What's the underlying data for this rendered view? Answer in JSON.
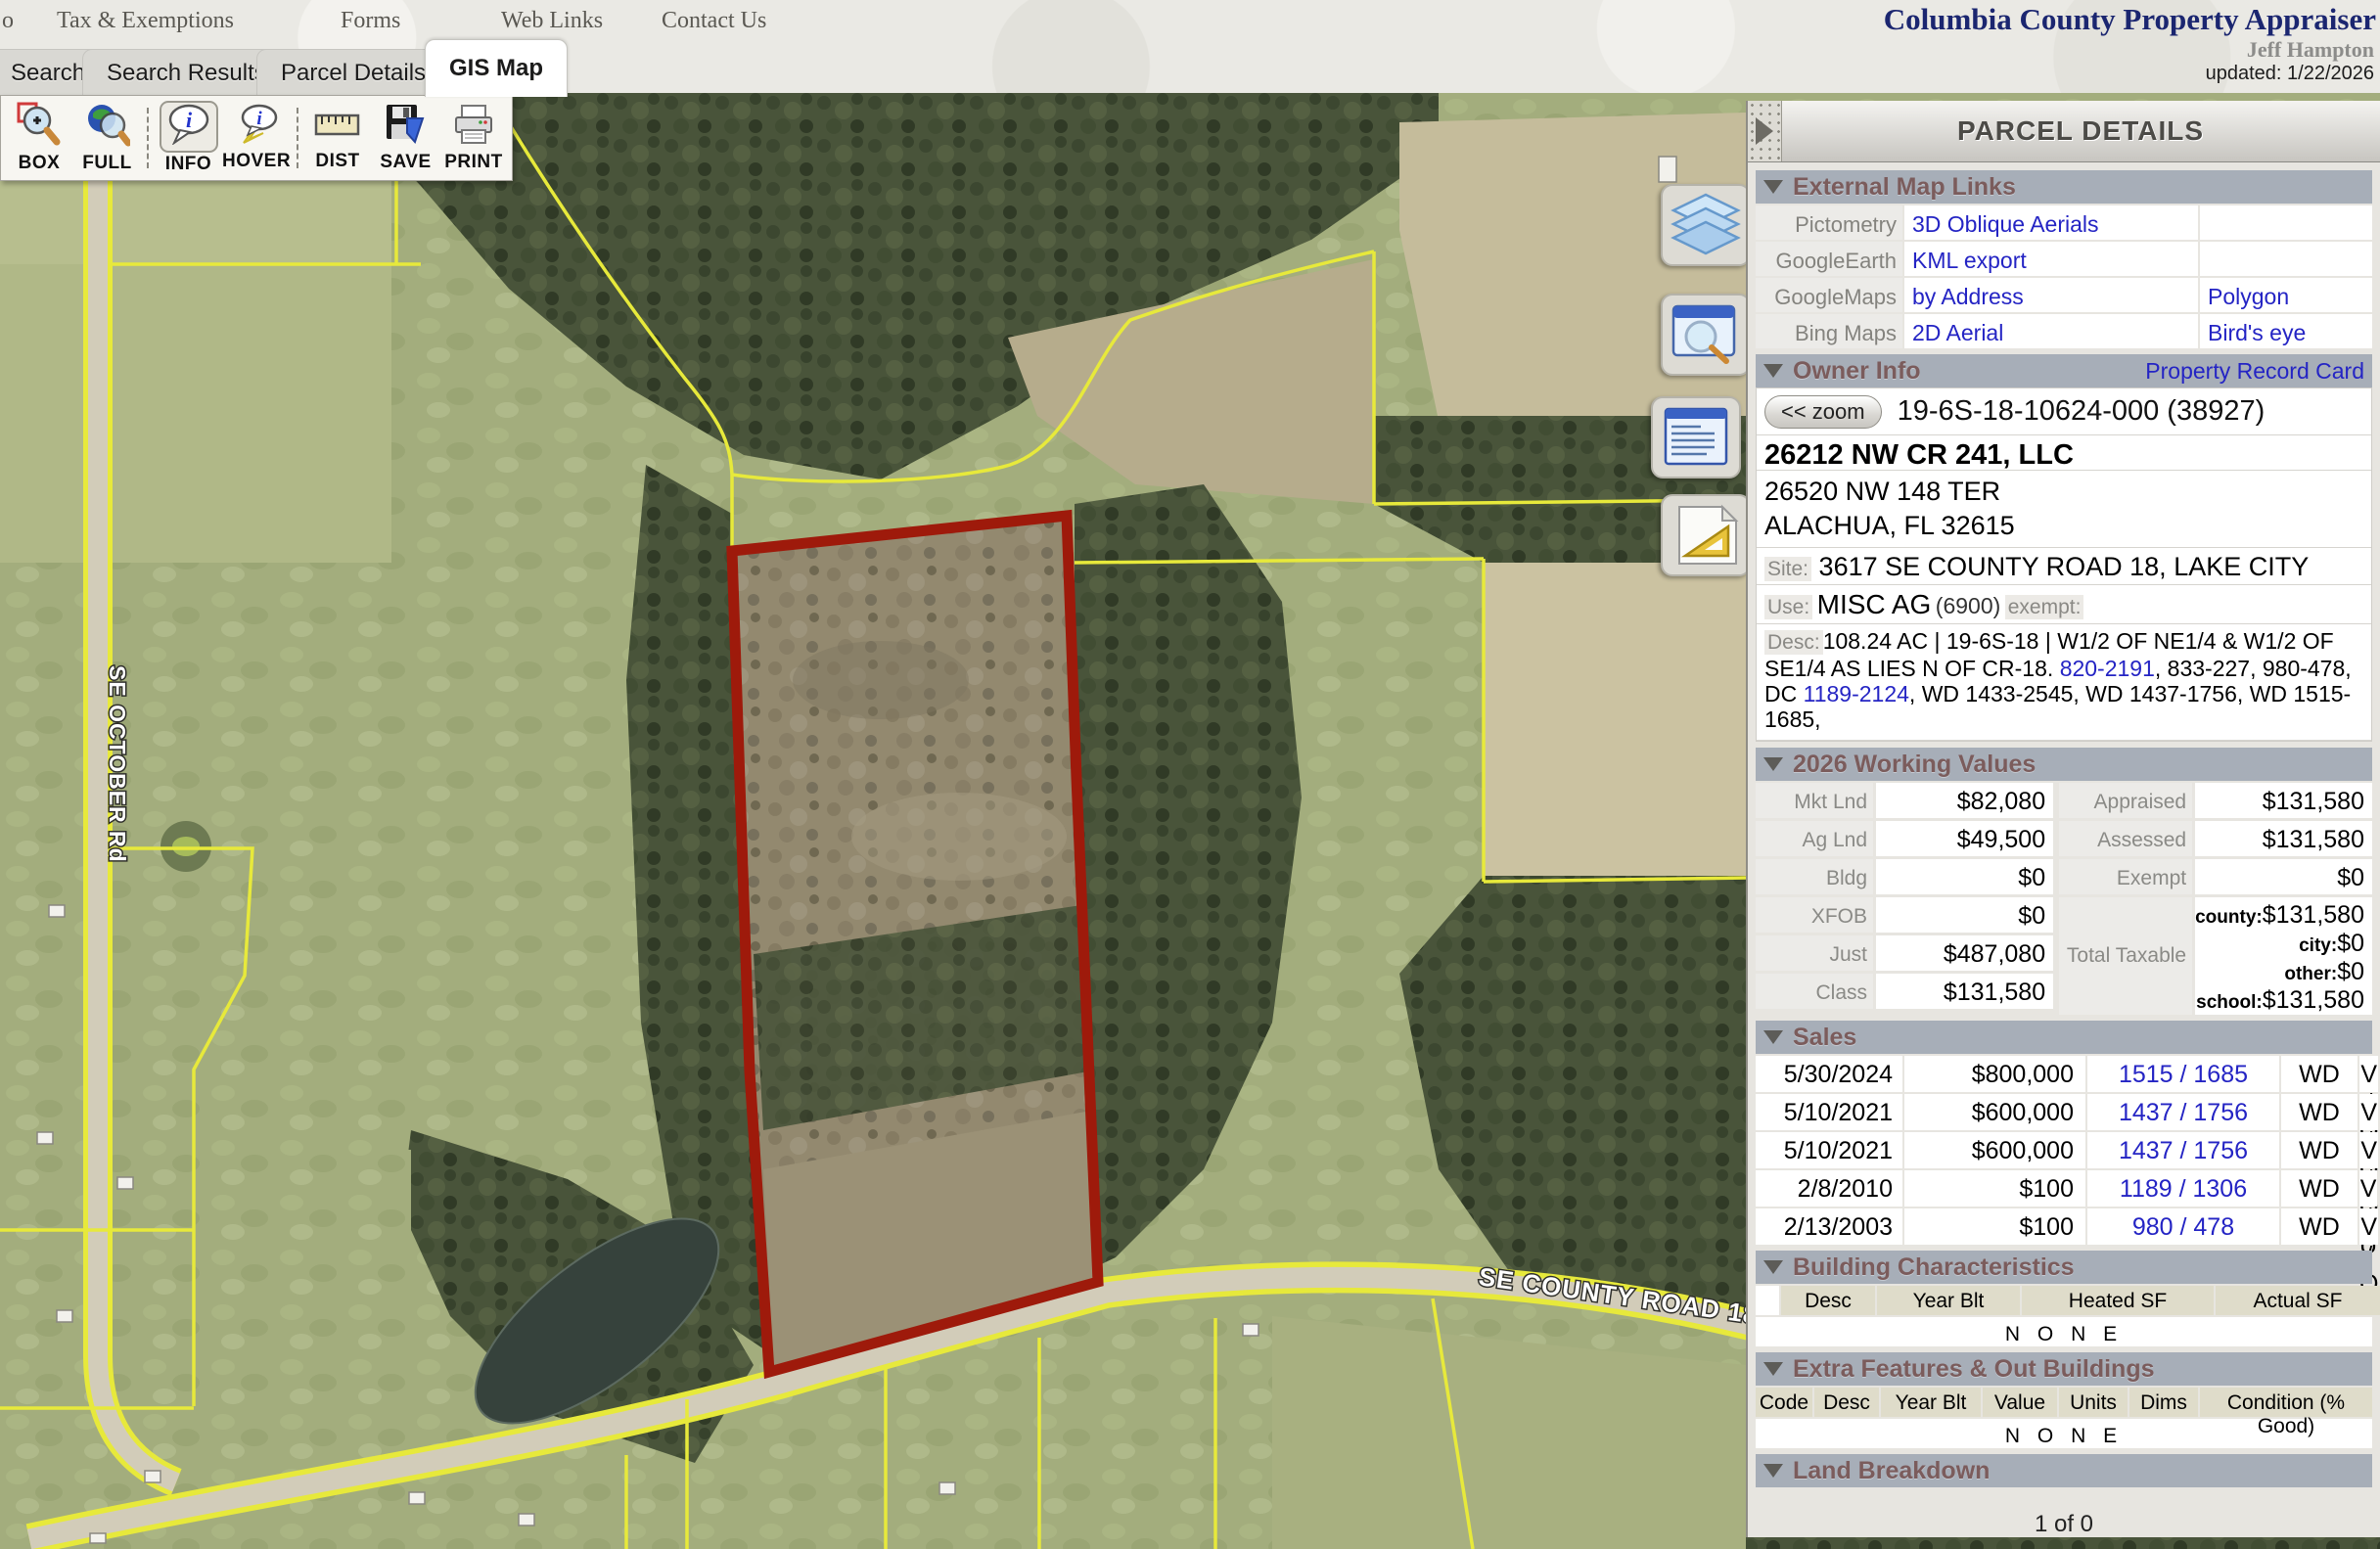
{
  "header": {
    "nav_partial": "o",
    "nav_items": [
      "Tax & Exemptions",
      "Forms",
      "Web Links",
      "Contact Us"
    ],
    "title": "Columbia County Property Appraiser",
    "appraiser": "Jeff Hampton",
    "updated": "updated: 1/22/2026"
  },
  "tabs": [
    {
      "label": "Search"
    },
    {
      "label": "Search Results"
    },
    {
      "label": "Parcel Details"
    },
    {
      "label": "GIS Map"
    }
  ],
  "toolbar": {
    "buttons": [
      {
        "label": "BOX",
        "icon": "zoom-box-icon"
      },
      {
        "label": "FULL",
        "icon": "zoom-full-icon"
      },
      {
        "label": "INFO",
        "icon": "info-bubble-icon",
        "active": true
      },
      {
        "label": "HOVER",
        "icon": "hover-bubble-icon"
      },
      {
        "label": "DIST",
        "icon": "distance-ruler-icon"
      },
      {
        "label": "SAVE",
        "icon": "save-disk-icon"
      },
      {
        "label": "PRINT",
        "icon": "printer-icon"
      }
    ]
  },
  "side_tools": [
    {
      "icon": "layers-icon"
    },
    {
      "icon": "identify-window-icon"
    },
    {
      "icon": "report-window-icon"
    },
    {
      "icon": "measure-icon"
    }
  ],
  "map": {
    "labels": {
      "vertical_road": "SE OCTOBER Rd",
      "bottom_road": "SE COUNTY ROAD 18"
    },
    "colors": {
      "parcel_outline": "#9e1a0b",
      "boundary_lines": "#e7e93b"
    }
  },
  "panel": {
    "title": "PARCEL DETAILS",
    "external_links": {
      "title": "External Map Links",
      "rows": [
        {
          "label": "Pictometry",
          "link1": "3D Oblique Aerials",
          "link2": ""
        },
        {
          "label": "GoogleEarth",
          "link1": "KML export",
          "link2": ""
        },
        {
          "label": "GoogleMaps",
          "link1": "by Address",
          "link2": "Polygon"
        },
        {
          "label": "Bing Maps",
          "link1": "2D Aerial",
          "link2": "Bird's eye"
        }
      ]
    },
    "owner_info": {
      "title": "Owner Info",
      "record_card": "Property Record Card",
      "zoom_button": "<< zoom",
      "parcel_id": "19-6S-18-10624-000 (38927)",
      "owner_name": "26212 NW CR 241, LLC",
      "address_line1": "26520 NW 148 TER",
      "address_line2": "ALACHUA, FL 32615",
      "site_label": "Site:",
      "site_value": "3617 SE COUNTY ROAD 18, LAKE CITY",
      "use_label": "Use:",
      "use_value": "MISC AG",
      "use_code": "(6900)",
      "exempt_label": "exempt:",
      "desc_label": "Desc:",
      "desc_part1": "108.24 AC |  19-6S-18 | W1/2 OF NE1/4 & W1/2 OF SE1/4 AS LIES N OF CR-18.  ",
      "desc_link1": "820-2191",
      "desc_part2": ", 833-227, 980-478, DC ",
      "desc_link2": "1189-2124",
      "desc_part3": ", WD 1433-2545, WD 1437-1756, WD 1515-1685,"
    },
    "working_values": {
      "title": "2026 Working Values",
      "left": [
        {
          "label": "Mkt Lnd",
          "value": "$82,080"
        },
        {
          "label": "Ag Lnd",
          "value": "$49,500"
        },
        {
          "label": "Bldg",
          "value": "$0"
        },
        {
          "label": "XFOB",
          "value": "$0"
        },
        {
          "label": "Just",
          "value": "$487,080"
        },
        {
          "label": "Class",
          "value": "$131,580"
        }
      ],
      "right": [
        {
          "label": "Appraised",
          "value": "$131,580"
        },
        {
          "label": "Assessed",
          "value": "$131,580"
        },
        {
          "label": "Exempt",
          "value": "$0"
        }
      ],
      "taxable_label": "Total Taxable",
      "taxable": [
        {
          "k": "county:",
          "v": "$131,580"
        },
        {
          "k": "city:",
          "v": "$0"
        },
        {
          "k": "other:",
          "v": "$0"
        },
        {
          "k": "school:",
          "v": "$131,580"
        }
      ]
    },
    "sales": {
      "title": "Sales",
      "rows": [
        {
          "date": "5/30/2024",
          "price": "$800,000",
          "book_page": "1515 / 1685",
          "deed": "WD",
          "vq": "V / Q"
        },
        {
          "date": "5/10/2021",
          "price": "$600,000",
          "book_page": "1437 / 1756",
          "deed": "WD",
          "vq": "V / Q"
        },
        {
          "date": "5/10/2021",
          "price": "$600,000",
          "book_page": "1437 / 1756",
          "deed": "WD",
          "vq": "V / Q"
        },
        {
          "date": "2/8/2010",
          "price": "$100",
          "book_page": "1189 / 1306",
          "deed": "WD",
          "vq": "V / U"
        },
        {
          "date": "2/13/2003",
          "price": "$100",
          "book_page": "980 / 478",
          "deed": "WD",
          "vq": "V / Q"
        }
      ]
    },
    "building": {
      "title": "Building Characteristics",
      "headers": [
        "Desc",
        "Year Blt",
        "Heated SF",
        "Actual SF",
        "Value"
      ],
      "none": "N O N E"
    },
    "extra_features": {
      "title": "Extra Features & Out Buildings",
      "headers": [
        "Code",
        "Desc",
        "Year Blt",
        "Value",
        "Units",
        "Dims",
        "Condition (% Good)"
      ],
      "none": "N O N E"
    },
    "land": {
      "title": "Land Breakdown"
    },
    "pager": "1 of 0"
  }
}
